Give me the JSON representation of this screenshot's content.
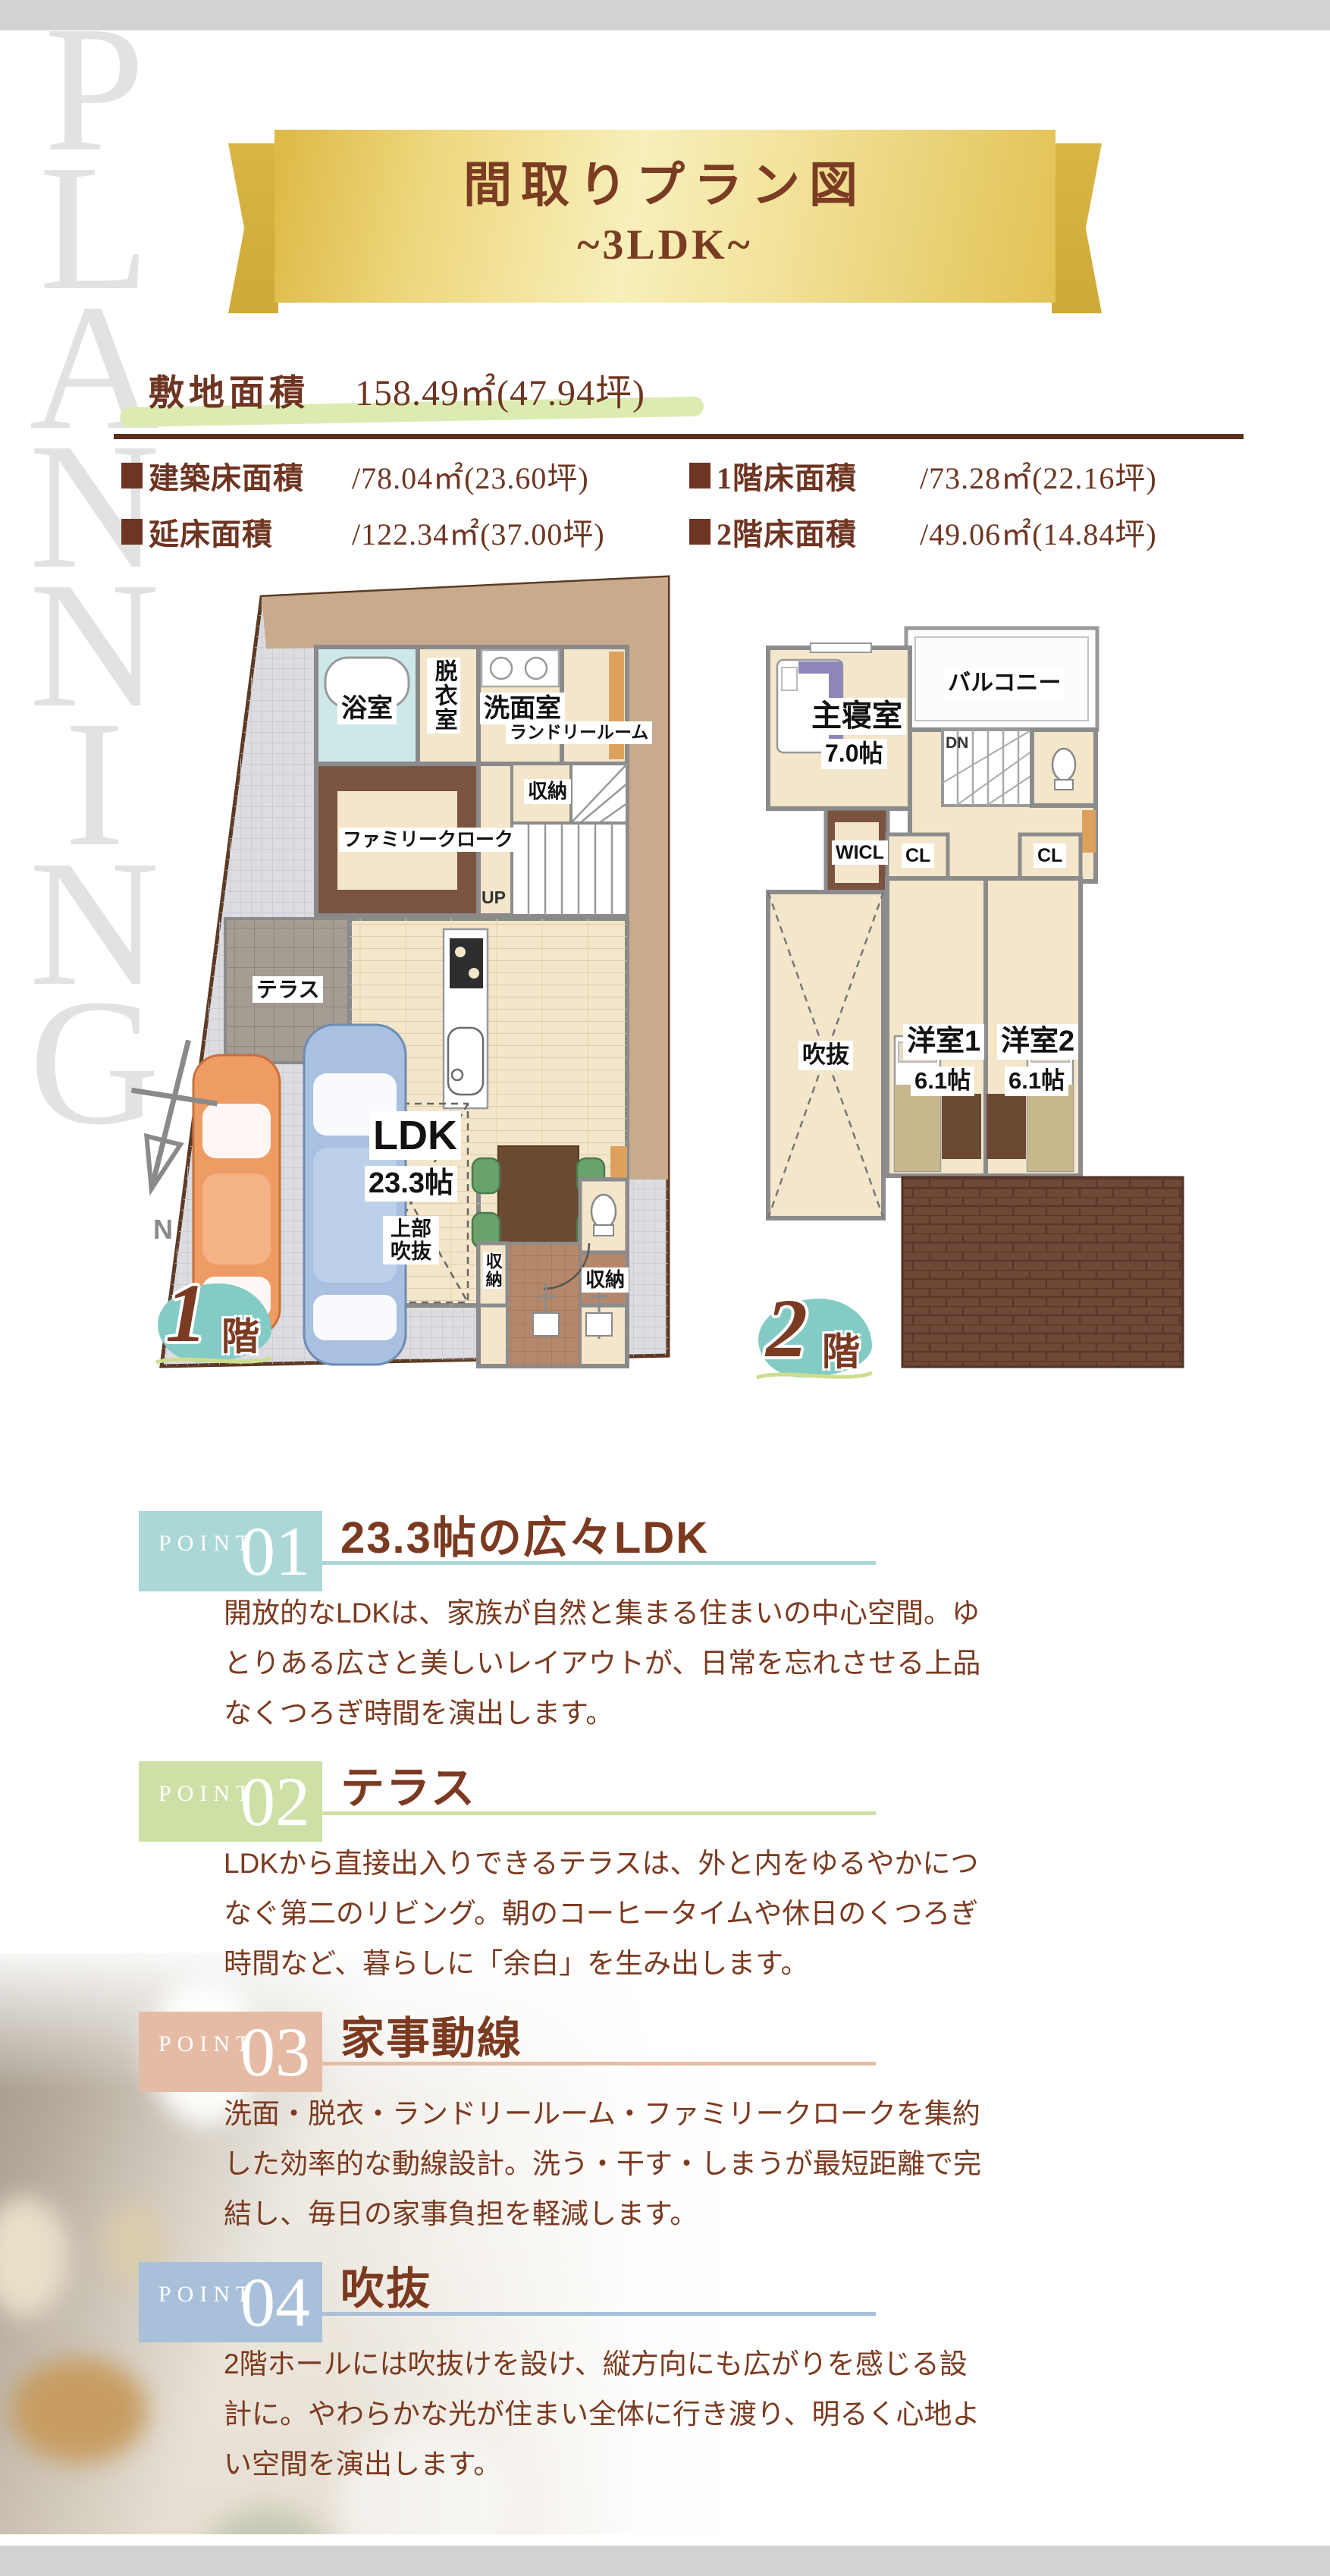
{
  "page": {
    "watermark": "PLANNING"
  },
  "banner": {
    "title": "間取りプラン図",
    "subtitle": "~3LDK~"
  },
  "site": {
    "label": "敷地面積",
    "value": "158.49㎡(47.94坪)"
  },
  "areas": [
    {
      "label": "建築床面積",
      "value": "/78.04㎡(23.60坪)"
    },
    {
      "label": "1階床面積",
      "value": "/73.28㎡(22.16坪)"
    },
    {
      "label": "延床面積",
      "value": "/122.34㎡(37.00坪)"
    },
    {
      "label": "2階床面積",
      "value": "/49.06㎡(14.84坪)"
    }
  ],
  "plan1": {
    "badge_num": "1",
    "badge_kanji": "階",
    "compass": "N",
    "labels": {
      "bath": "浴室",
      "dressing": "脱衣室",
      "wash": "洗面室",
      "laundry": "ランドリールーム",
      "family_cloak": "ファミリークローク",
      "closet": "収納",
      "up": "UP",
      "terrace": "テラス",
      "ldk": "LDK",
      "ldk_size": "23.3帖",
      "void_upper": "上部吹抜",
      "storage_left": "収納",
      "storage_right": "収納"
    }
  },
  "plan2": {
    "badge_num": "2",
    "badge_kanji": "階",
    "labels": {
      "balcony": "バルコニー",
      "master": "主寝室",
      "master_size": "7.0帖",
      "dn": "DN",
      "wicl": "WICL",
      "cl1": "CL",
      "cl2": "CL",
      "room1": "洋室1",
      "room1_size": "6.1帖",
      "room2": "洋室2",
      "room2_size": "6.1帖",
      "void": "吹抜"
    }
  },
  "points": [
    {
      "eyebrow": "POINT",
      "num": "01",
      "title": "23.3帖の広々LDK",
      "accent": "#abd7d7",
      "body": "開放的なLDKは、家族が自然と集まる住まいの中心空間。ゆとりある広さと美しいレイアウトが、日常を忘れさせる上品なくつろぎ時間を演出します。"
    },
    {
      "eyebrow": "POINT",
      "num": "02",
      "title": "テラス",
      "accent": "#cde1a6",
      "body": "LDKから直接出入りできるテラスは、外と内をゆるやかにつなぐ第二のリビング。朝のコーヒータイムや休日のくつろぎ時間など、暮らしに「余白」を生み出します。"
    },
    {
      "eyebrow": "POINT",
      "num": "03",
      "title": "家事動線",
      "accent": "#e6bba6",
      "body": "洗面・脱衣・ランドリールーム・ファミリークロークを集約した効率的な動線設計。洗う・干す・しまうが最短距離で完結し、毎日の家事負担を軽減します。"
    },
    {
      "eyebrow": "POINT",
      "num": "04",
      "title": "吹抜",
      "accent": "#a9c0da",
      "body": "2階ホールには吹抜けを設け、縦方向にも広がりを感じる設計に。やわらかな光が住まい全体に行き渡り、明るく心地よい空間を演出します。"
    }
  ]
}
